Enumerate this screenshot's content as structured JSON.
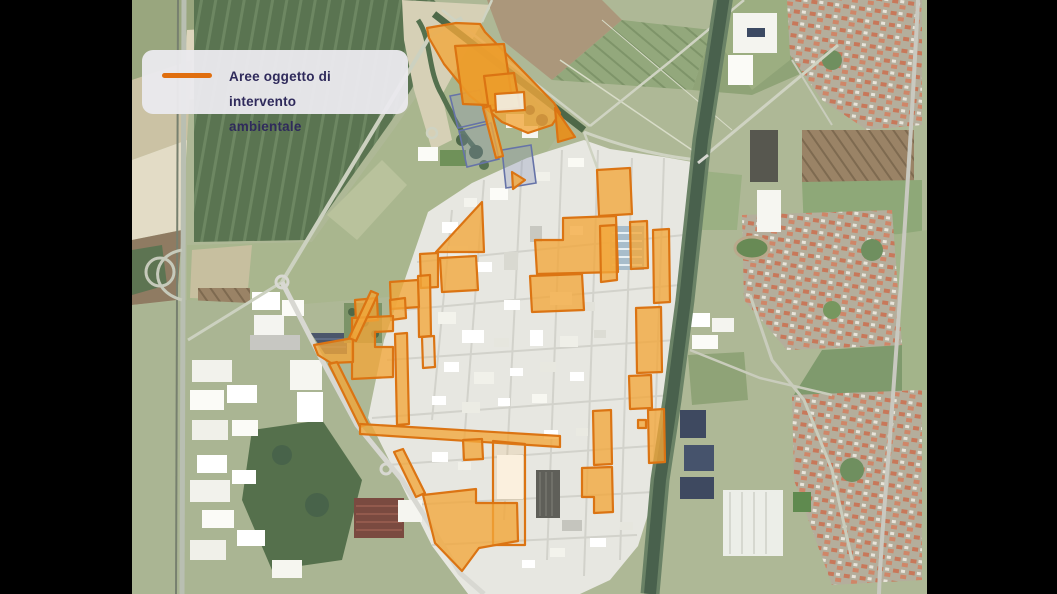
{
  "frame": {
    "background": "#000000",
    "letterbox_left_width": 132,
    "letterbox_right_width": 130
  },
  "legend": {
    "line1": "Aree oggetto di intervento",
    "line2": "ambientale",
    "swatch_color": "#e06e0e",
    "text_color": "#2f2a5b",
    "background_color": "#eae9ed"
  },
  "map": {
    "kind": "aerial-satellite-photo",
    "subject": "industrial district with farmland, canal, railway and residential town",
    "overlay": {
      "label": "Aree oggetto di intervento ambientale",
      "stroke": "#db7413",
      "fill": "#f2a63a",
      "fill_inner": "#ec9c2b",
      "fill_dark": "#e68f1d",
      "fill_excluded": "#f2efe5",
      "intervention_areas": [
        {
          "id": "north-main",
          "variant": "filled",
          "points": "295,28 324,23 348,24 353,32 422,103 428,113 420,125 396,133 370,122 356,110 338,96 312,64 297,38"
        },
        {
          "id": "north-tip-triangle",
          "variant": "dark",
          "points": "423,108 443,137 426,142"
        },
        {
          "id": "north-inner-1",
          "variant": "inner",
          "points": "323,46 372,44 381,106 331,104"
        },
        {
          "id": "north-inner-2",
          "variant": "inner",
          "points": "352,76 382,73 388,108 357,111"
        },
        {
          "id": "north-excluded-parcel",
          "variant": "excluded",
          "points": "363,94 392,92 393,110 364,112"
        },
        {
          "id": "north-strip",
          "variant": "filled",
          "points": "351,108 358,106 371,156 364,158"
        },
        {
          "id": "north-small-triangle",
          "variant": "filled",
          "points": "380,172 393,180 381,189"
        },
        {
          "id": "ind-top-rect",
          "variant": "filled",
          "points": "465,170 498,168 500,214 467,216"
        },
        {
          "id": "ind-big-L",
          "variant": "filled",
          "points": "403,240 431,240 431,218 484,216 486,272 405,274"
        },
        {
          "id": "ind-mid-block",
          "variant": "filled",
          "points": "398,276 450,274 452,310 400,312"
        },
        {
          "id": "canal-col-1",
          "variant": "filled",
          "points": "468,226 484,225 485,280 469,282"
        },
        {
          "id": "canal-col-2",
          "variant": "filled",
          "points": "498,222 515,221 516,268 499,269"
        },
        {
          "id": "canal-col-3",
          "variant": "filled",
          "points": "521,230 537,229 538,302 522,303"
        },
        {
          "id": "canal-col-4",
          "variant": "filled",
          "points": "504,308 529,307 530,372 505,373"
        },
        {
          "id": "canal-col-5",
          "variant": "filled",
          "points": "497,376 519,375 520,408 498,409"
        },
        {
          "id": "canal-col-6",
          "variant": "filled",
          "points": "516,410 532,409 533,462 517,463"
        },
        {
          "id": "nw-triangle",
          "variant": "filled",
          "points": "350,202 352,252 304,252"
        },
        {
          "id": "nw-quad-1",
          "variant": "filled",
          "points": "288,254 306,253 306,287 289,288"
        },
        {
          "id": "nw-quad-2",
          "variant": "filled",
          "points": "308,258 344,256 346,290 310,292"
        },
        {
          "id": "nw-strip-down",
          "variant": "filled",
          "points": "286,276 298,275 299,336 287,337"
        },
        {
          "id": "west-quad-1",
          "variant": "filled",
          "points": "258,282 286,280 287,307 259,309"
        },
        {
          "id": "west-quad-2",
          "variant": "filled",
          "points": "223,300 245,298 246,320 224,322"
        },
        {
          "id": "west-quad-3",
          "variant": "filled",
          "points": "258,300 273,298 274,318 259,320"
        },
        {
          "id": "west-big-block",
          "variant": "filled",
          "points": "220,318 261,316 261,331 243,332 243,347 261,347 261,377 220,379"
        },
        {
          "id": "west-thin-strip",
          "variant": "filled",
          "points": "263,334 275,333 277,424 265,425"
        },
        {
          "id": "west-wedge",
          "variant": "filled",
          "points": "182,345 221,338 221,362 199,363 186,355"
        },
        {
          "id": "boundary-strip-a",
          "variant": "filled",
          "points": "239,291 246,294 224,341 217,338"
        },
        {
          "id": "boundary-strip-b",
          "variant": "filled",
          "points": "197,364 205,362 236,424 228,427"
        },
        {
          "id": "boundary-strip-c",
          "variant": "filled",
          "points": "262,452 271,449 293,493 284,497"
        },
        {
          "id": "south-band",
          "variant": "filled",
          "points": "228,424 428,436 428,447 228,434"
        },
        {
          "id": "south-hanging-rect",
          "variant": "filled",
          "points": "331,440 350,439 351,459 332,460"
        },
        {
          "id": "south-outline-strip",
          "variant": "outline",
          "points": "361,441 393,444 393,545 361,545"
        },
        {
          "id": "west-outline-rect",
          "variant": "outline",
          "points": "290,337 302,336 303,367 291,368"
        },
        {
          "id": "south-vertical-bar",
          "variant": "filled",
          "points": "461,411 479,410 480,464 462,465"
        },
        {
          "id": "south-L-block",
          "variant": "filled",
          "points": "450,468 480,467 481,512 462,513 462,497 450,497"
        },
        {
          "id": "south-big-poly",
          "variant": "filled",
          "points": "291,495 344,489 344,503 385,503 386,541 347,548 330,571 303,543"
        },
        {
          "id": "south-small-square",
          "variant": "filled",
          "points": "506,420 514,420 514,428 506,428"
        }
      ],
      "secondary_areas": {
        "stroke": "#6673a8",
        "fill": "#8391bd",
        "polygons": [
          {
            "id": "blue-parcel-1",
            "points": "318,96 348,90 356,121 326,128"
          },
          {
            "id": "blue-parcel-2",
            "points": "327,131 359,123 367,159 335,167"
          },
          {
            "id": "blue-parcel-3",
            "points": "370,150 399,145 404,183 374,188"
          }
        ]
      }
    }
  }
}
